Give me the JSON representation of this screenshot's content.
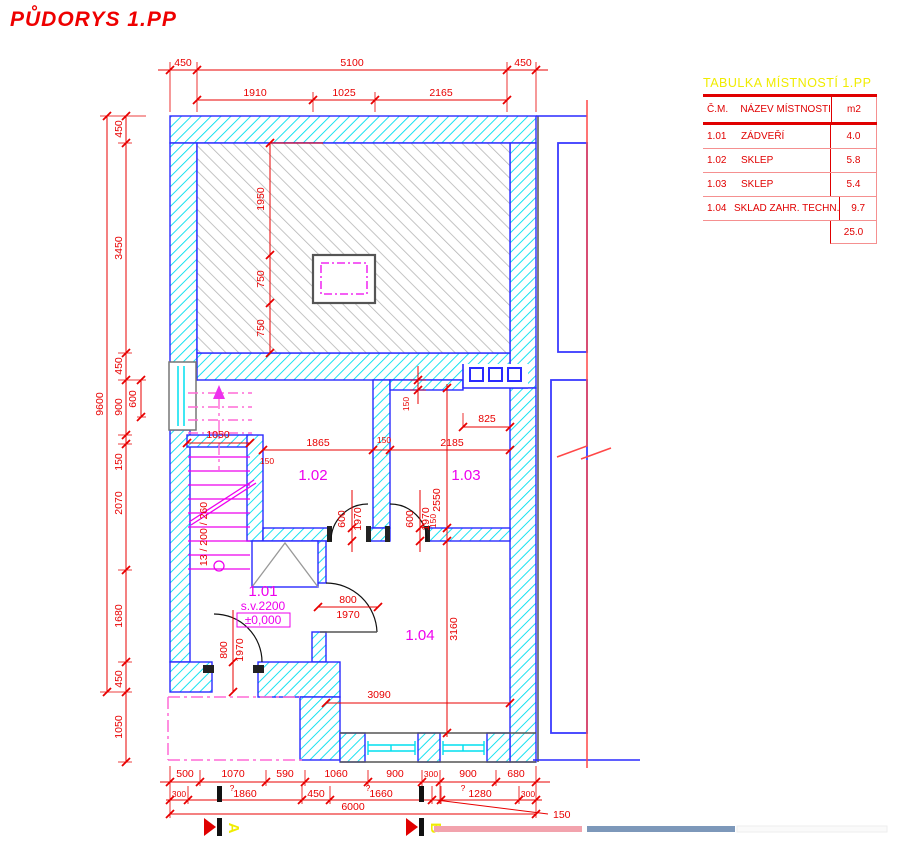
{
  "title": "PŮDORYS 1.PP",
  "table": {
    "title": "TABULKA MÍSTNOSTÍ 1.PP",
    "headers": {
      "num": "Č.M.",
      "name": "NÁZEV MÍSTNOSTI",
      "area": "m2"
    },
    "rows": [
      {
        "num": "1.01",
        "name": "ZÁDVEŘÍ",
        "area": "4.0"
      },
      {
        "num": "1.02",
        "name": "SKLEP",
        "area": "5.8"
      },
      {
        "num": "1.03",
        "name": "SKLEP",
        "area": "5.4"
      },
      {
        "num": "1.04",
        "name": "SKLAD ZAHR. TECHN.",
        "area": "9.7"
      }
    ],
    "total": "25.0"
  },
  "rooms": {
    "r101": {
      "number": "1.01",
      "height": "s.v.2200",
      "level": "±0,000"
    },
    "r102": {
      "number": "1.02"
    },
    "r103": {
      "number": "1.03"
    },
    "r104": {
      "number": "1.04"
    }
  },
  "stair": {
    "label": "13 / 200 / 260"
  },
  "sections": {
    "a": "A",
    "b": "B"
  },
  "dims": {
    "top1": [
      "450",
      "5100",
      "450"
    ],
    "top2": [
      "1910",
      "1025",
      "2165"
    ],
    "left_total": "9600",
    "left": [
      "450",
      "3450",
      "450",
      "900",
      "150",
      "2070",
      "1680",
      "450"
    ],
    "left_sub": "600",
    "left_porch": "1050",
    "roof": [
      "1950",
      "750",
      "750"
    ],
    "stair_width": "1050",
    "stair_wall": "150",
    "row_mid": [
      "1865",
      "150",
      "2185"
    ],
    "notch": "825",
    "wall_top": "150",
    "r103_h": "2550",
    "wall_right": "150",
    "r104_h": "3160",
    "r104_w": "3090",
    "door_w": "600",
    "door_h": "1970",
    "door2_w": "800",
    "bottom1": [
      "500",
      "1070",
      "590",
      "1060",
      "900",
      "300",
      "900",
      "680"
    ],
    "bottom2": [
      "300",
      "1860",
      "450",
      "1660",
      "1280",
      "300"
    ],
    "q": "?",
    "total_w": "6000",
    "offset150": "150"
  },
  "colors": {
    "dim_red": "#e80000",
    "wall_blue": "#2a2aff",
    "hatch_cyan": "#00dfef",
    "magenta": "#ee00ee",
    "yellow": "#f0ec00",
    "pink_bar": "#f2a3ad",
    "blue_bar": "#7d98ba"
  }
}
